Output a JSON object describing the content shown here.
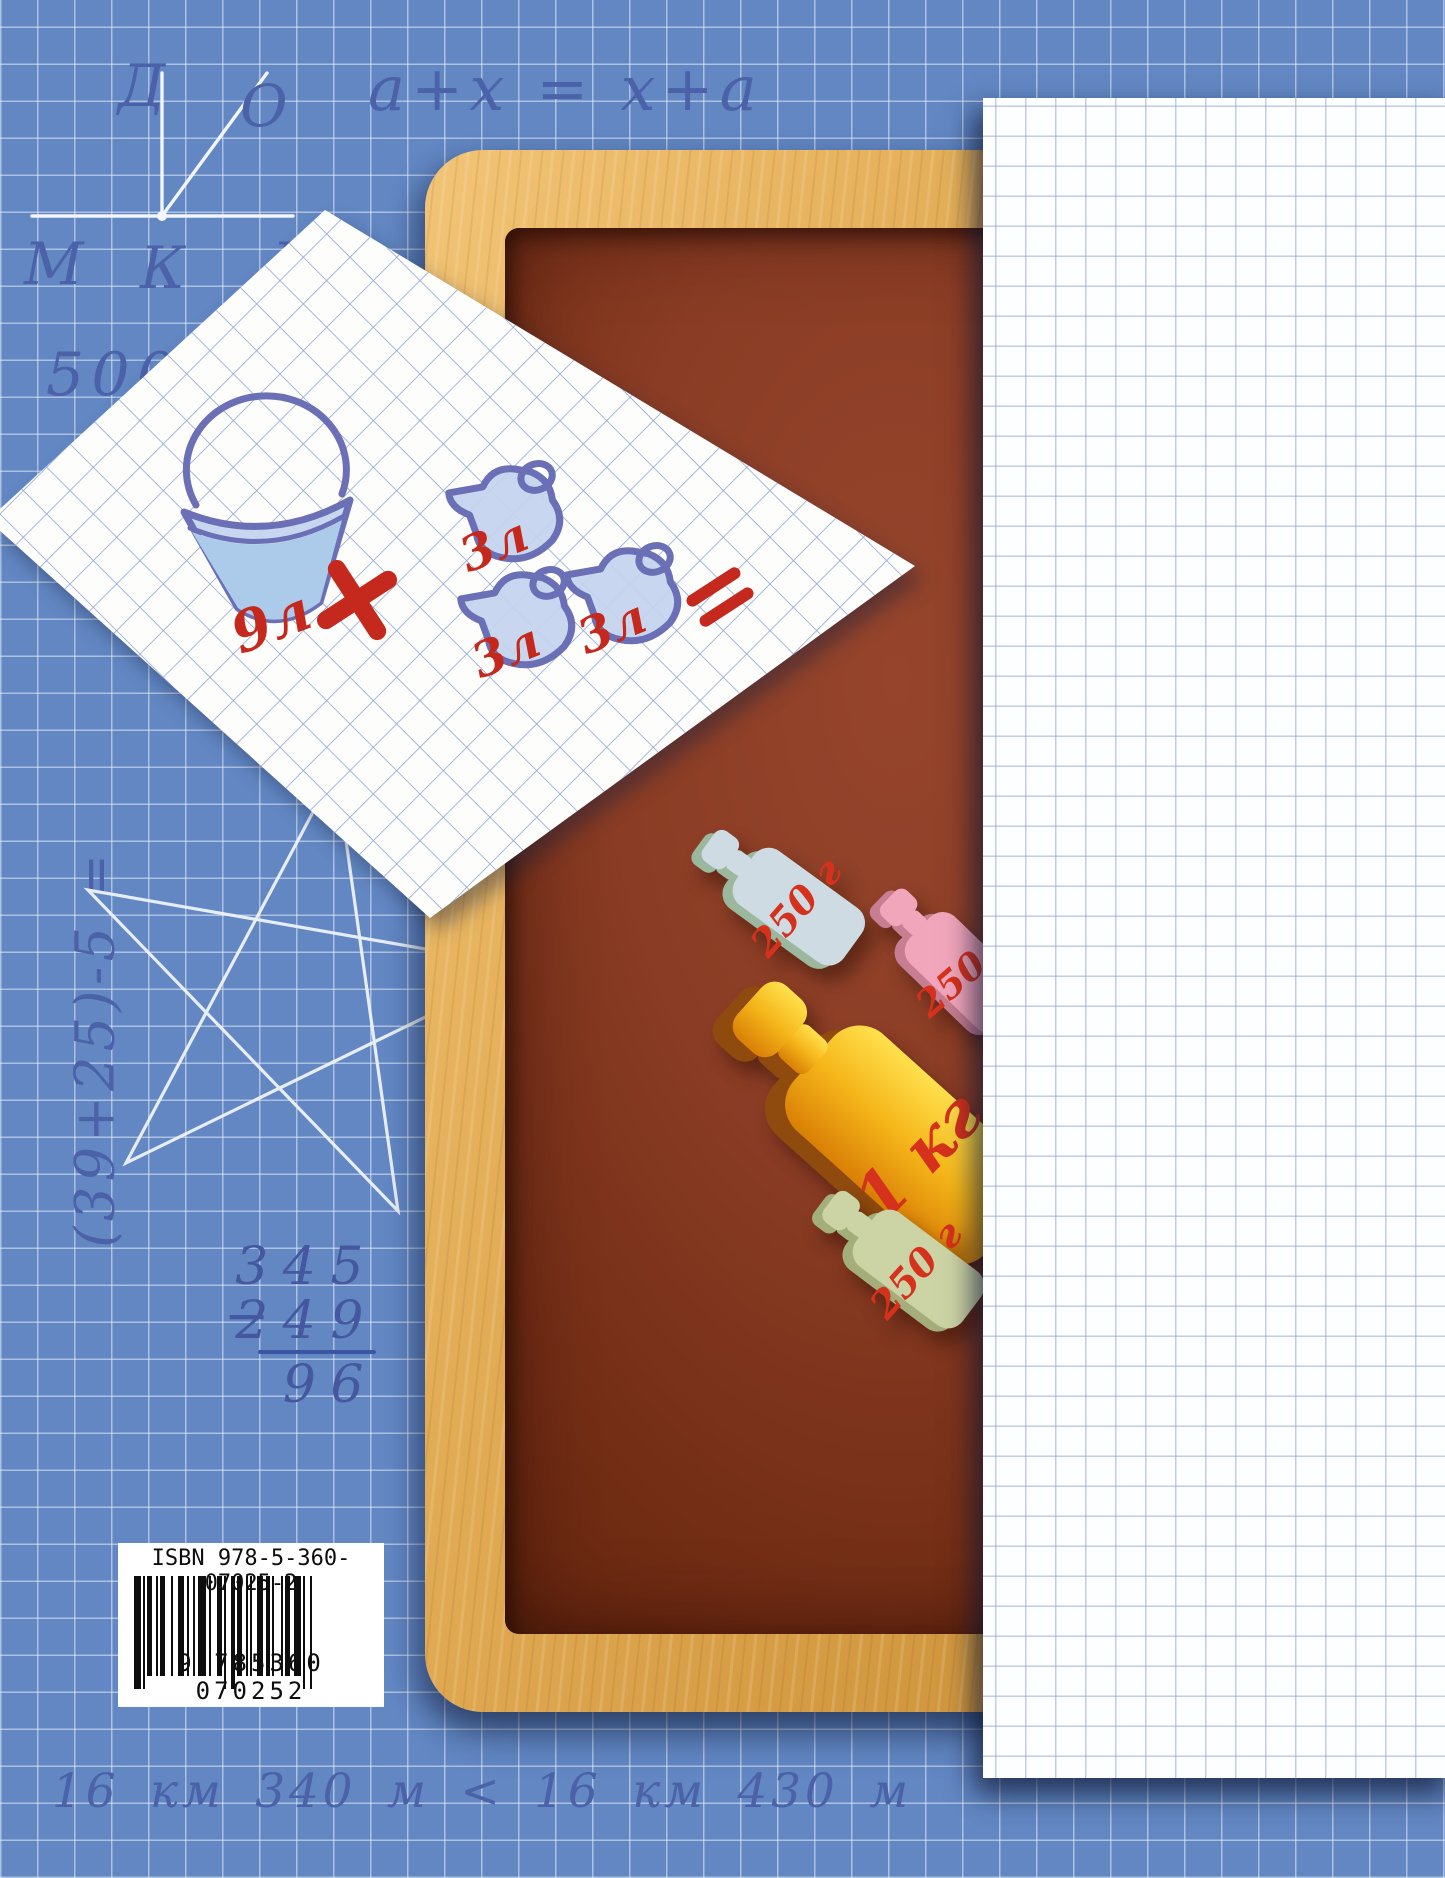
{
  "page": {
    "type": "math textbook back cover"
  },
  "board_notes": {
    "angle_figure_labels": {
      "top": "Д",
      "diagonal": "О",
      "left": "М",
      "vertex": "К",
      "right": "В"
    },
    "commutative_formula": "a+x = x+a",
    "comparison": "500 < 900",
    "vertical_expression": "(39+25)-5 =",
    "column_subtraction": {
      "minus_sign": "−",
      "minuend": "345",
      "subtrahend": "249",
      "difference": "96"
    },
    "length_comparison": "16 км 340 м < 16 км 430 м"
  },
  "paper_note": {
    "bucket_label": "9л",
    "plus_sign": "+",
    "jug_labels": [
      "3л",
      "3л",
      "3л"
    ],
    "equals_sign": "="
  },
  "weights": {
    "blue": {
      "label": "250 г"
    },
    "pink": {
      "label": "250 г"
    },
    "gold": {
      "label": "1 кг"
    },
    "green": {
      "label": "250 г"
    }
  },
  "barcode": {
    "isbn": "ISBN 978-5-360-07025-2",
    "number": "9 785360 070252"
  },
  "colors": {
    "background": "#6287c3",
    "handwriting": "#4b61a8",
    "chalk_lines": "#f2f5fa",
    "red_marker": "#c5281c",
    "board_surface": "#84381f",
    "wood_frame": "#dda44c",
    "paper_grid": "#8ba1d4",
    "strip_grid": "#94a3d4"
  }
}
